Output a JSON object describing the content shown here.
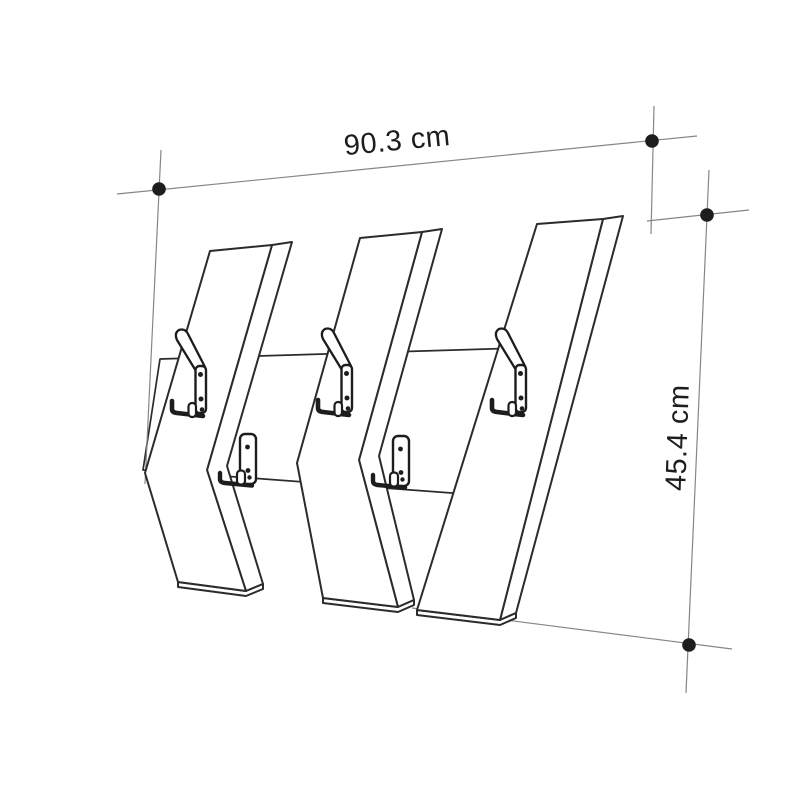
{
  "diagram": {
    "kind": "product dimension drawing",
    "subject": "wall coat rack with three slanted planks, a horizontal back rail, three double hooks and two single hooks",
    "dimensions": {
      "width": {
        "label": "90.3 cm",
        "value": 90.3,
        "unit": "cm"
      },
      "height": {
        "label": "45.4 cm",
        "value": 45.4,
        "unit": "cm"
      }
    },
    "counts": {
      "planks": 3,
      "double_hooks": 3,
      "single_hooks": 2,
      "dimension_markers": 4
    },
    "colors": {
      "background": "#ffffff",
      "drawing_line": "#2b2b29",
      "extension_line": "#868686",
      "marker_dot": "#1d1d1b",
      "text": "#1d1d1b"
    }
  }
}
